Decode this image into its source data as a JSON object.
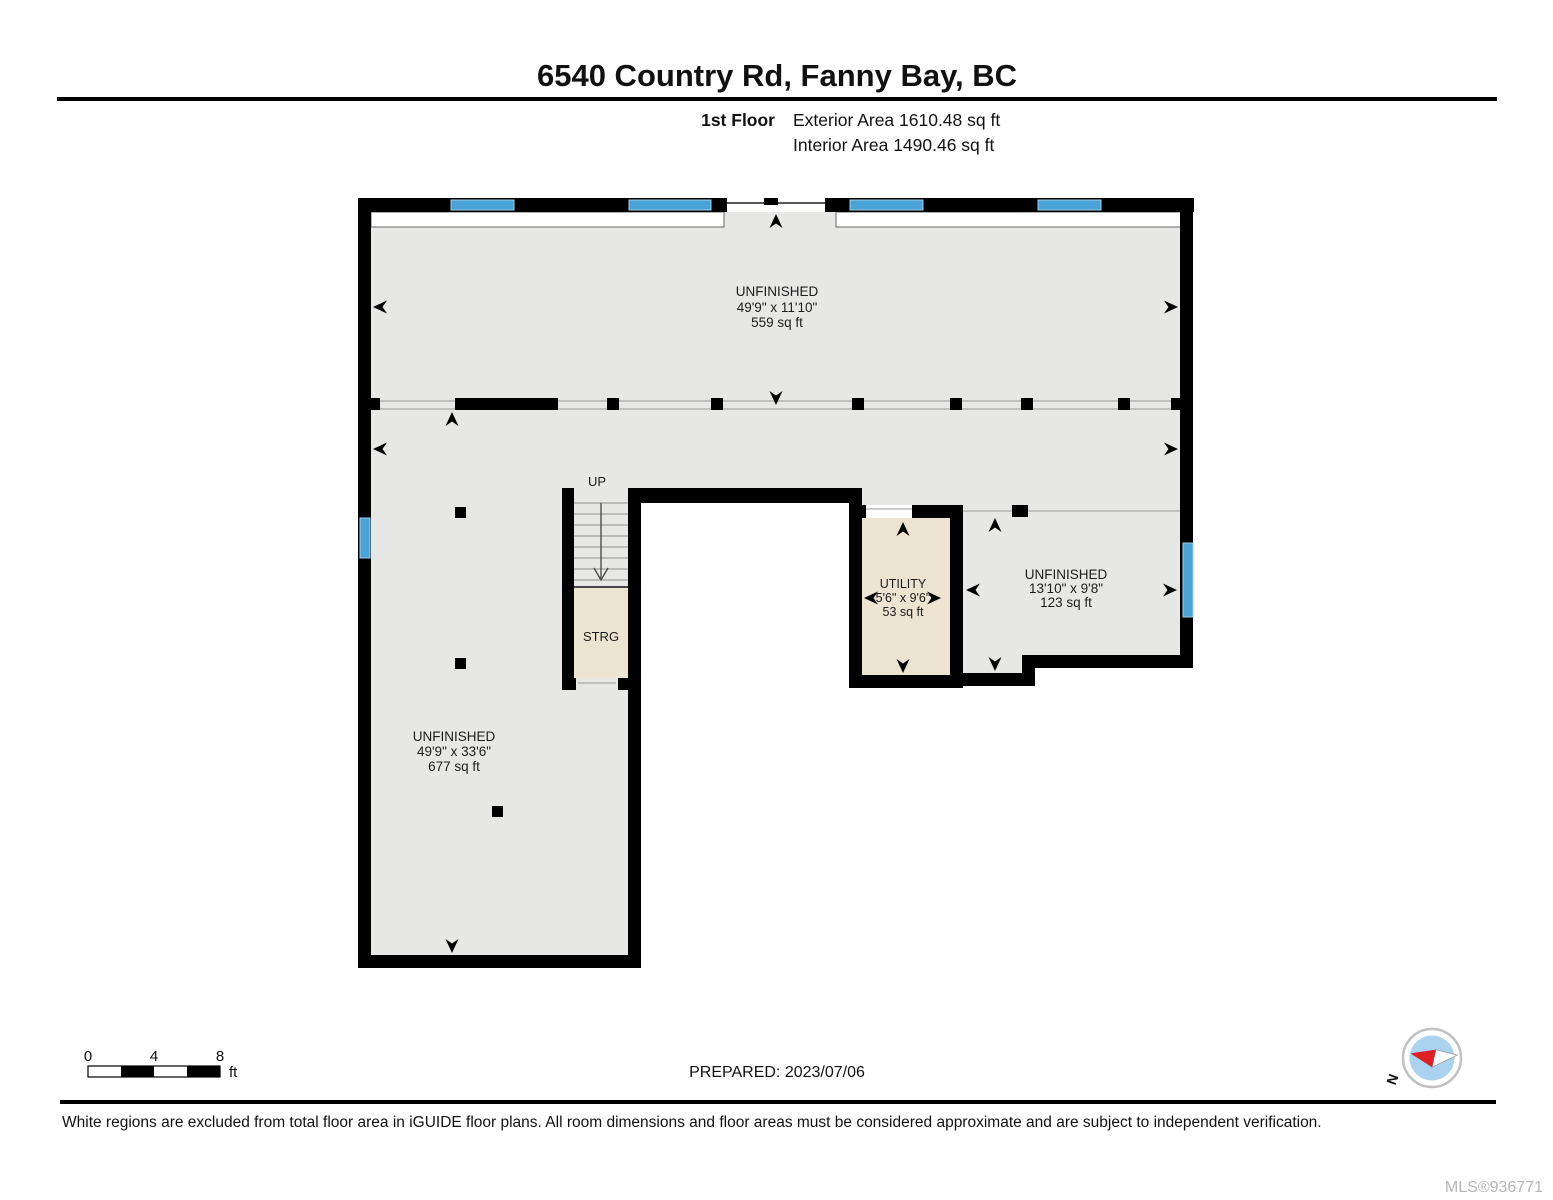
{
  "header": {
    "title": "6540 Country Rd, Fanny Bay, BC",
    "floor_label": "1st Floor",
    "exterior_area": "Exterior Area 1610.48 sq ft",
    "interior_area": "Interior Area 1490.46 sq ft"
  },
  "rooms": {
    "unfinished_top": {
      "name": "UNFINISHED",
      "dims": "49'9\" x 11'10\"",
      "area": "559 sq ft"
    },
    "unfinished_left": {
      "name": "UNFINISHED",
      "dims": "49'9\" x 33'6\"",
      "area": "677 sq ft"
    },
    "utility": {
      "name": "UTILITY",
      "dims": "5'6\" x 9'6\"",
      "area": "53 sq ft"
    },
    "unfinished_right": {
      "name": "UNFINISHED",
      "dims": "13'10\" x 9'8\"",
      "area": "123 sq ft"
    },
    "storage": {
      "label": "STRG"
    },
    "stairs": {
      "label": "UP"
    }
  },
  "scale_bar": {
    "tick_0": "0",
    "tick_4": "4",
    "tick_8": "8",
    "unit": "ft"
  },
  "compass": {
    "north_label": "N"
  },
  "footer": {
    "prepared": "PREPARED: 2023/07/06",
    "disclaimer": "White regions are excluded from total floor area in iGUIDE floor plans. All room dimensions and floor areas must be considered approximate and are subject to independent verification.",
    "mls": "MLS®936771"
  },
  "colors": {
    "floor": "#e7e7e6",
    "wall": "#000000",
    "window": "#4aa3d7",
    "excluded_room": "#ece3d1",
    "compass_red": "#e01e25",
    "compass_blue": "#a9d3ef"
  }
}
